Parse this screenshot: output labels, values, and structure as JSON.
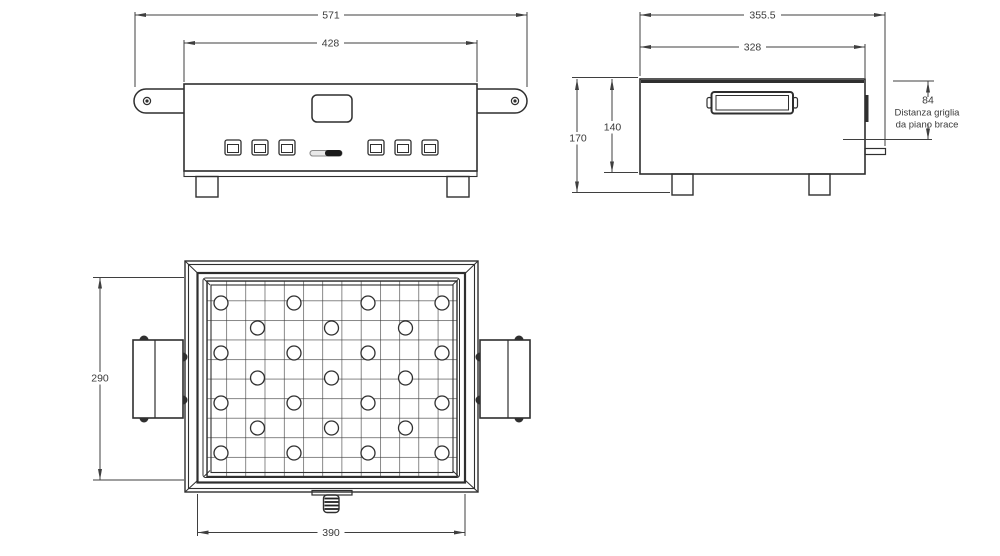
{
  "drawing_type": "technical-dimension-drawing",
  "views": {
    "front": {
      "label": "front view",
      "dim_overall_width": "571",
      "dim_body_width": "428"
    },
    "side": {
      "label": "side view",
      "dim_overall_depth": "355.5",
      "dim_body_depth": "328",
      "dim_overall_height": "170",
      "dim_body_height": "140",
      "dim_grill_gap": "84",
      "note_line1": "Distanza griglia",
      "note_line2": "da piano brace"
    },
    "top": {
      "label": "top view",
      "dim_grill_depth": "290",
      "dim_grill_width": "390"
    }
  },
  "colors": {
    "line": "#2f2f2f",
    "dim_line": "#3f3f3f",
    "text": "#3a3a3a",
    "background": "#ffffff"
  }
}
